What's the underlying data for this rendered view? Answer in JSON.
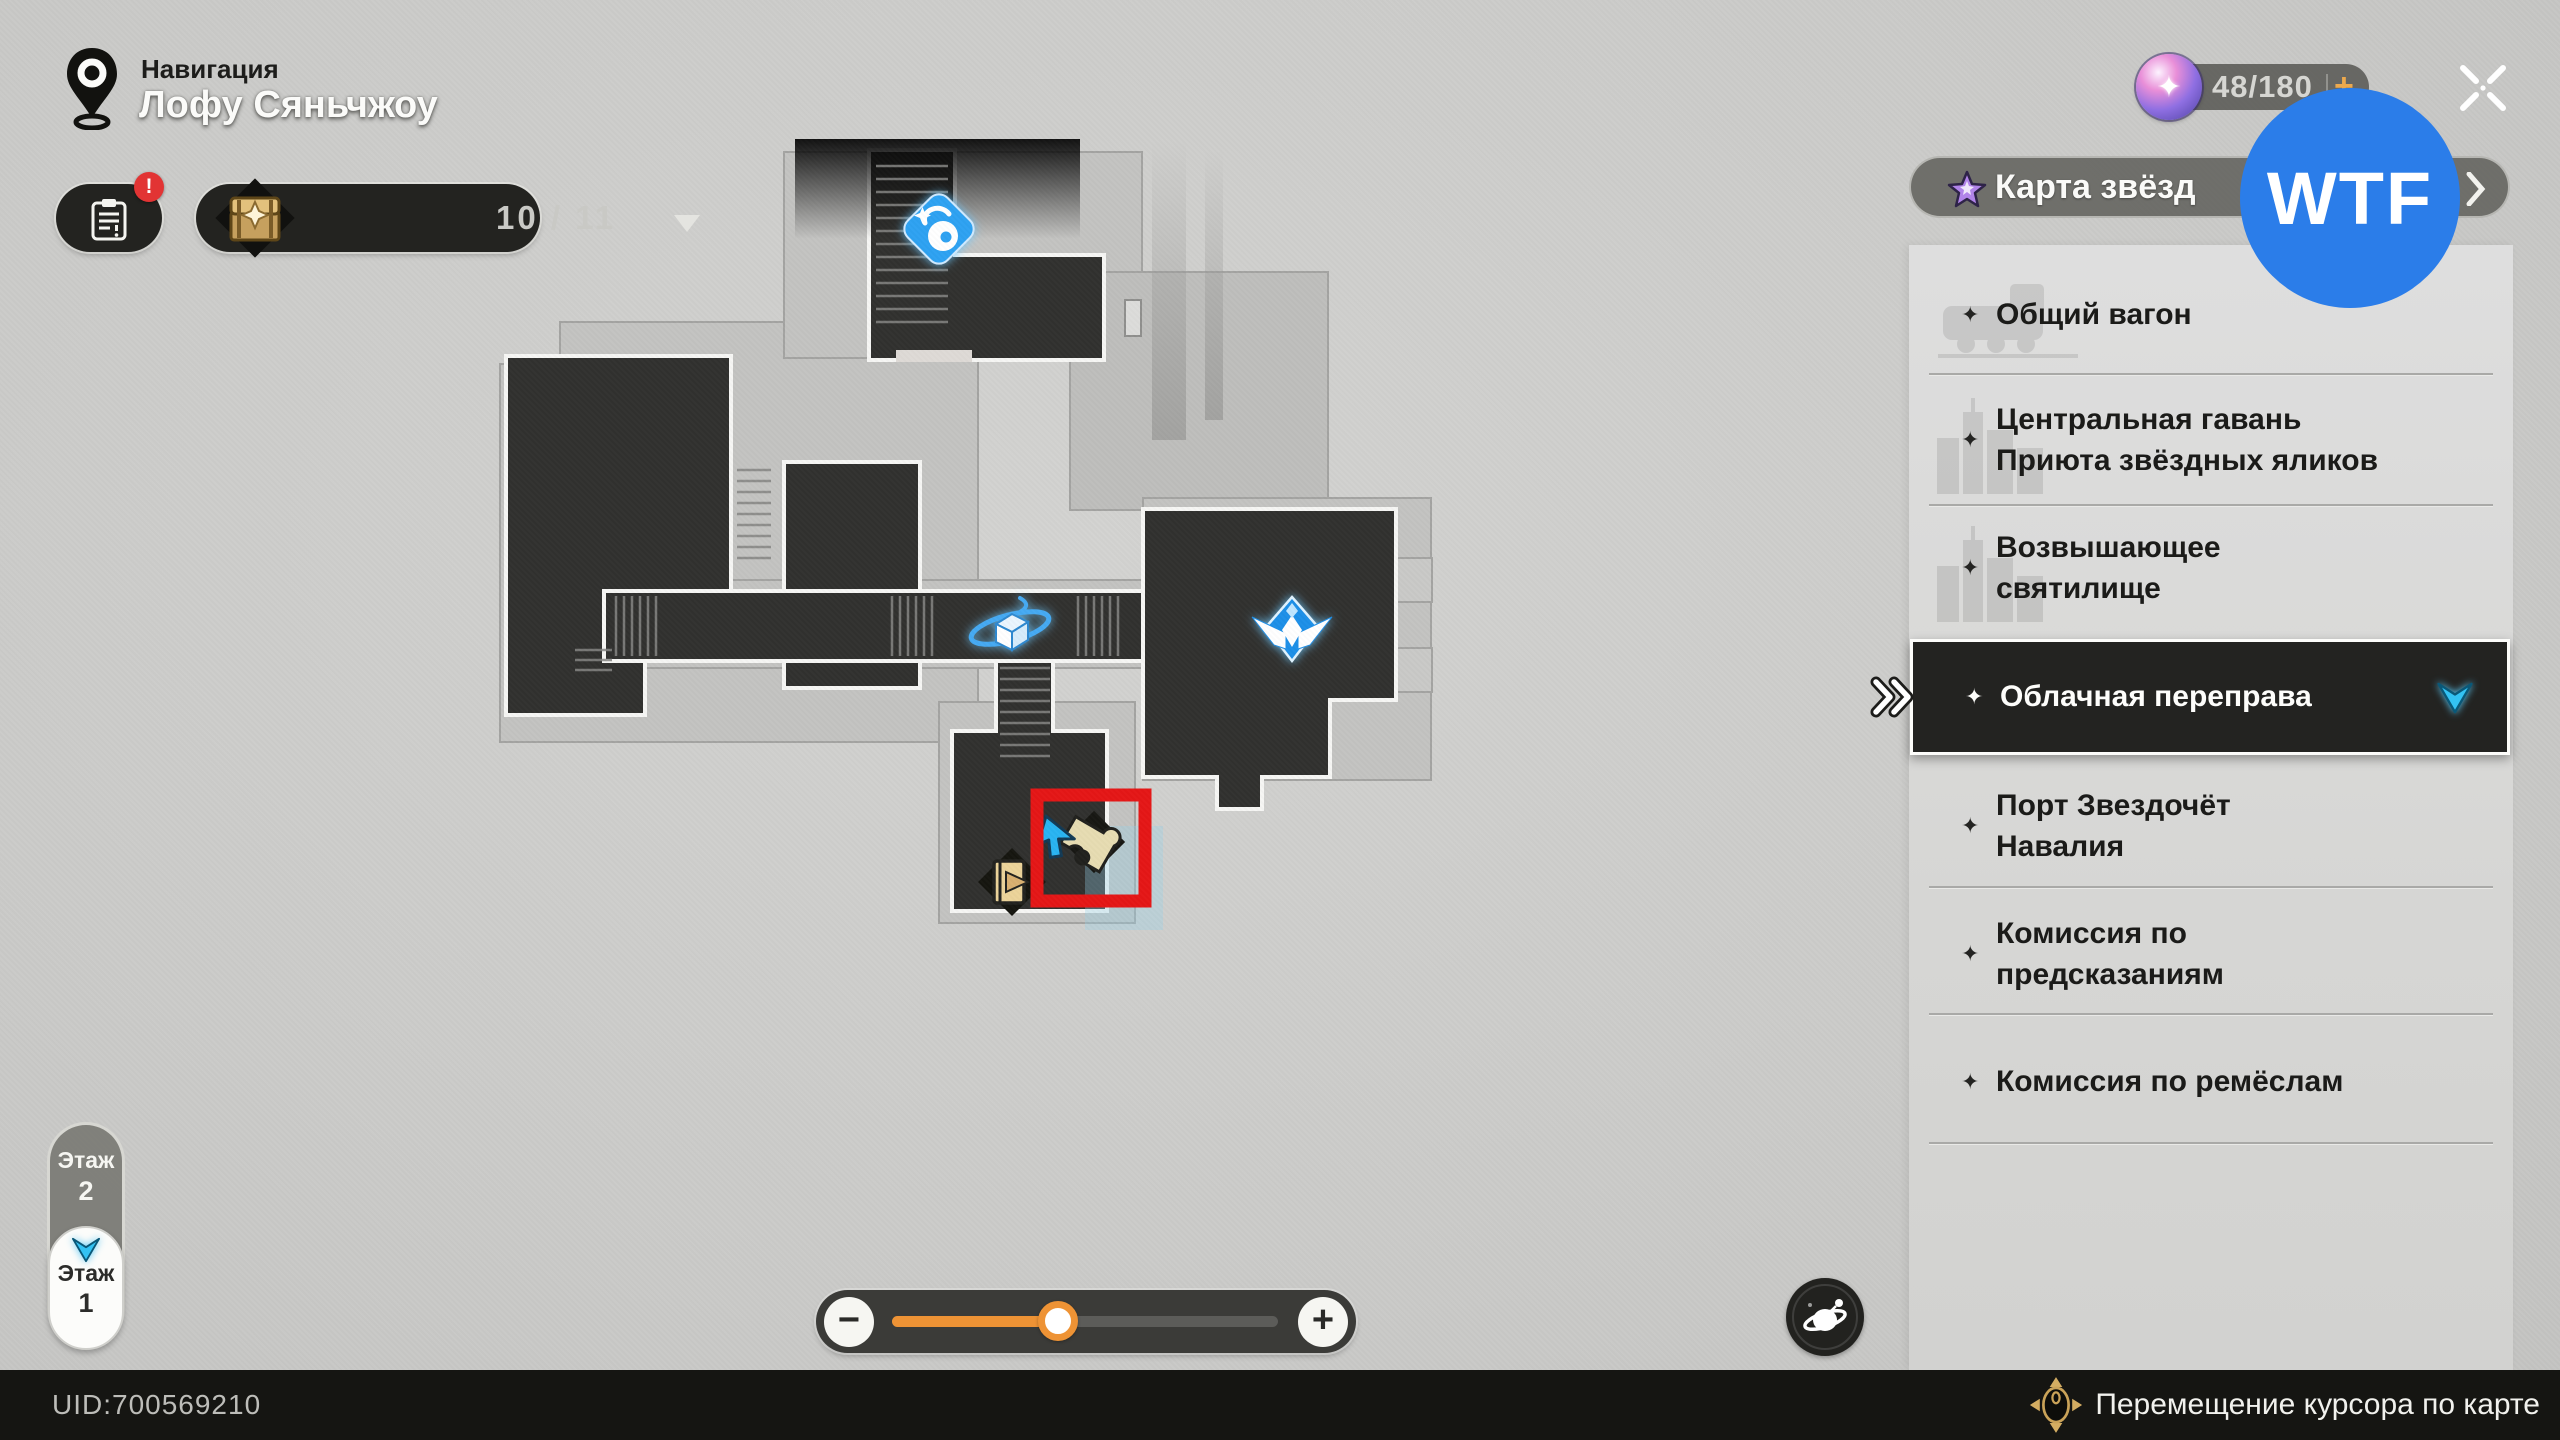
{
  "header": {
    "nav_label": "Навигация",
    "location_name": "Лофу Сяньчжоу"
  },
  "top_buttons": {
    "alert": "!",
    "chest_count": "10 / 11"
  },
  "currency": {
    "count": "48/180",
    "plus": "+"
  },
  "wtf_badge": "WTF",
  "icons": {
    "sparkle": "✦",
    "orb_star": "✦"
  },
  "sidebar": {
    "header_label": "Карта звёзд",
    "items": [
      {
        "line1": "Общий вагон",
        "selected": false
      },
      {
        "line1": "Центральная гавань",
        "line2": "Приюта звёздных яликов",
        "selected": false
      },
      {
        "line1": "Возвышающее",
        "line2": "святилище",
        "selected": false
      },
      {
        "line1": "Облачная переправа",
        "selected": true
      },
      {
        "line1": "Порт Звездочёт",
        "line2": "Навалия",
        "selected": false
      },
      {
        "line1": "Комиссия по",
        "line2": "предсказаниям",
        "selected": false
      },
      {
        "line1": "Комиссия по ремёслам",
        "selected": false
      }
    ]
  },
  "floor_selector": {
    "floor2_word": "Этаж",
    "floor2_num": "2",
    "floor1_word": "Этаж",
    "floor1_num": "1",
    "selected": "Этаж 1"
  },
  "zoom_slider": {
    "minus": "−",
    "plus": "+",
    "value_percent": 43
  },
  "status_bar": {
    "uid": "UID:700569210",
    "hint": "Перемещение курсора по карте"
  },
  "map": {
    "markers": [
      "dialogue-bubble-marker",
      "orbit-cube-marker",
      "space-anchor-marker",
      "exit-marker",
      "puzzle-marker",
      "cursor-arrow"
    ],
    "highlight": "red-annotation-box"
  }
}
